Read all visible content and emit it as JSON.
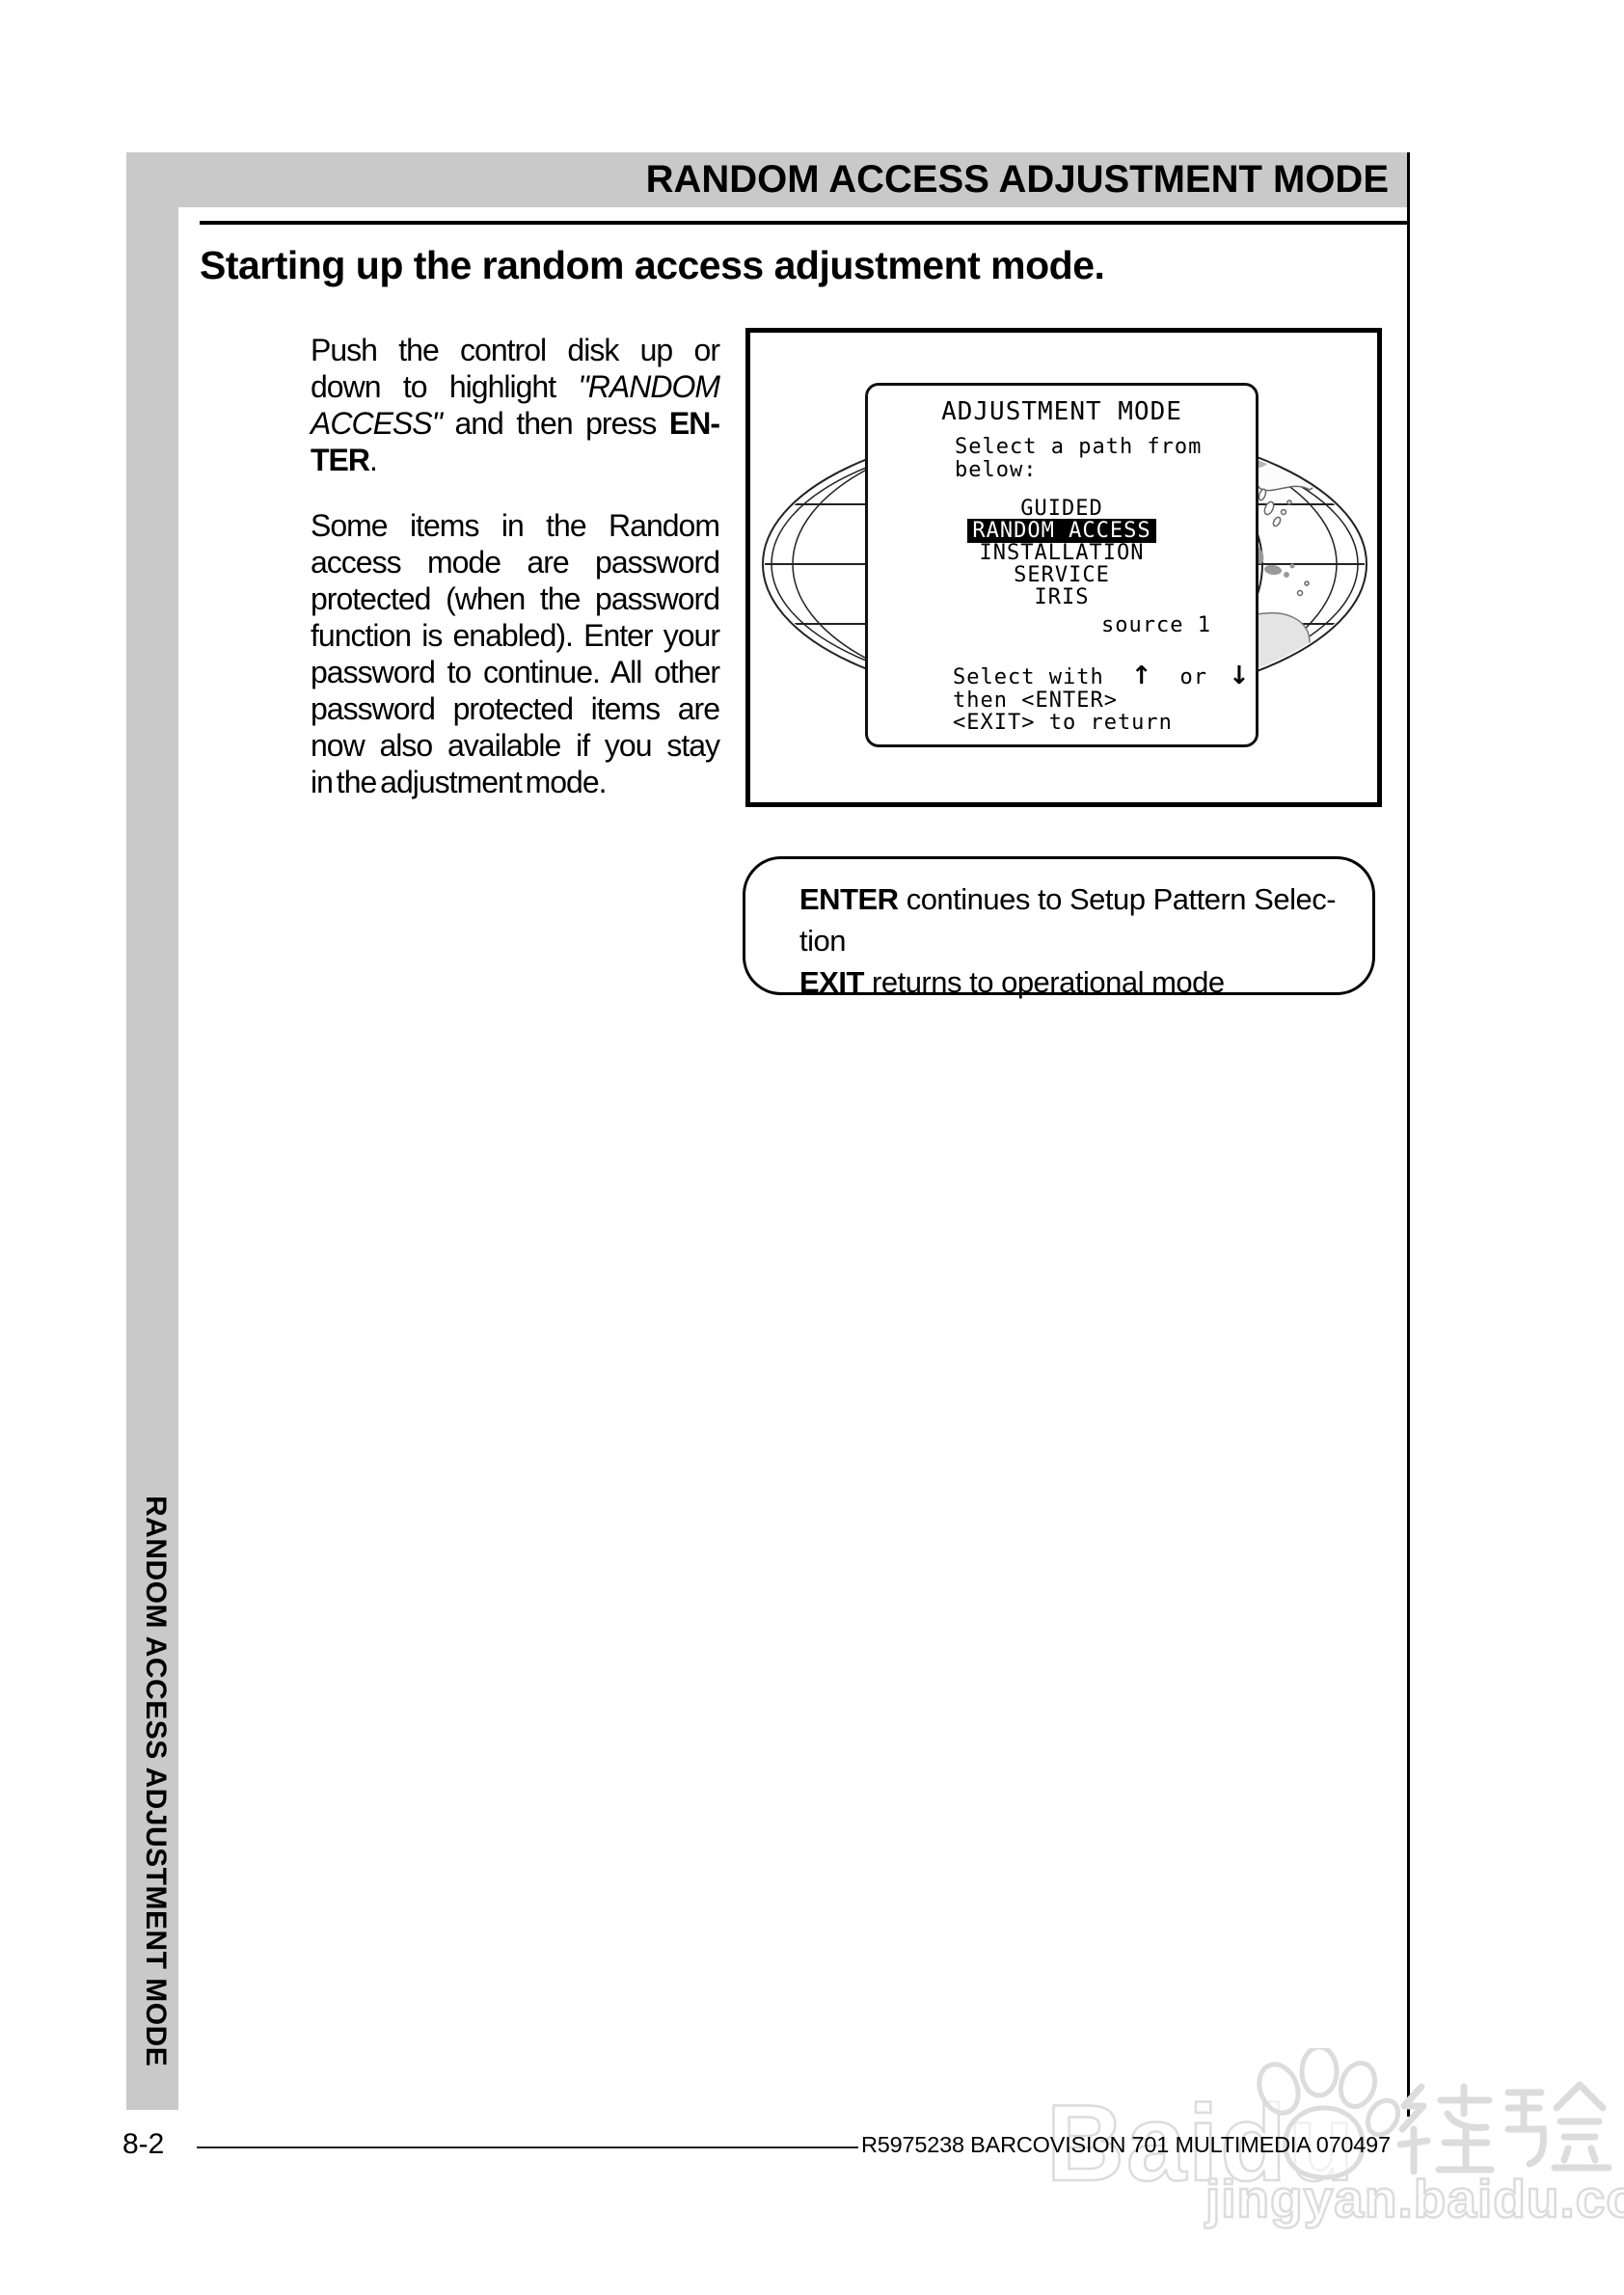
{
  "header": {
    "title": "RANDOM ACCESS ADJUSTMENT MODE"
  },
  "sidebar": {
    "label": "RANDOM ACCESS ADJUSTMENT MODE"
  },
  "section": {
    "heading": "Starting up the random access adjustment mode."
  },
  "body": {
    "para1_lines": [
      [
        {
          "t": "Push the control disk up or"
        }
      ],
      [
        {
          "t": "down to highlight "
        },
        {
          "t": "\"RANDOM",
          "i": true
        }
      ],
      [
        {
          "t": "ACCESS\"",
          "i": true
        },
        {
          "t": " and then press "
        },
        {
          "t": "EN-",
          "b": true
        }
      ],
      [
        {
          "t": "TER",
          "b": true
        },
        {
          "t": "."
        }
      ]
    ],
    "para2_lines": [
      "Some items in the Random",
      "access mode are password",
      "protected (when the password",
      "function is enabled). Enter your",
      "password to continue. All other",
      "password protected items are",
      "now also available if you stay",
      "in the adjustment mode."
    ]
  },
  "figure": {
    "menu": {
      "title": "ADJUSTMENT MODE",
      "prompt": [
        "Select a path from",
        "below:"
      ],
      "items": [
        "GUIDED",
        "RANDOM ACCESS",
        "INSTALLATION",
        "SERVICE",
        "IRIS"
      ],
      "selected_item": "RANDOM ACCESS",
      "source_label": "source 1",
      "hint_select": "Select with",
      "hint_or": "or",
      "arrow_up": "↑",
      "arrow_down": "↓",
      "hint_enter": "then <ENTER>",
      "hint_exit": "<EXIT> to return"
    }
  },
  "note": {
    "line1": [
      {
        "t": "ENTER",
        "b": true
      },
      {
        "t": " continues to Setup Pattern Selec-"
      }
    ],
    "line2": [
      {
        "t": "tion"
      }
    ],
    "line3": [
      {
        "t": "EXIT",
        "b": true
      },
      {
        "t": " returns to operational mode"
      }
    ]
  },
  "footer": {
    "page_number": "8-2",
    "doc_reference": "R5975238 BARCOVISION 701 MULTIMEDIA 070497"
  },
  "watermark": {
    "brand": "Baidu",
    "brand_cn": "经验",
    "url": "jingyan.baidu.com"
  },
  "colors": {
    "band_gray": "#c9c9c9",
    "highlight_bg": "#000000",
    "highlight_fg": "#ffffff",
    "watermark_gray": "#dcdcdc"
  }
}
